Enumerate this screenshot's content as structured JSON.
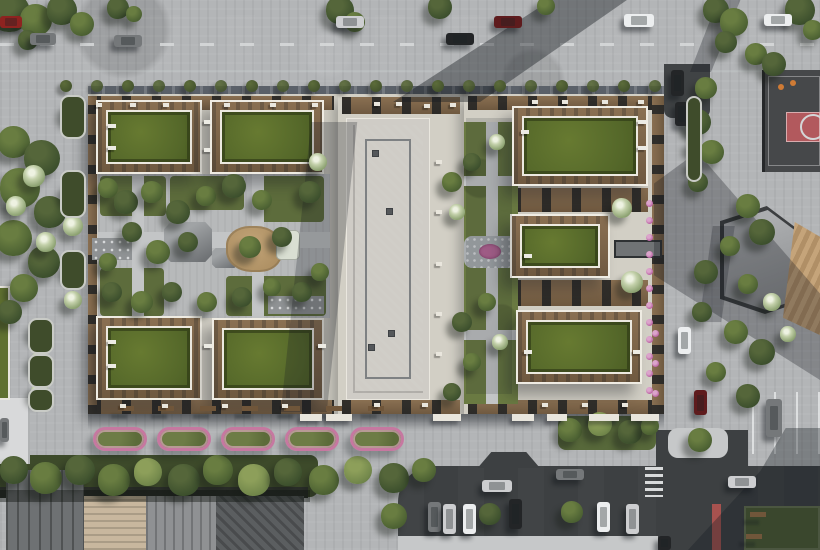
{
  "scene": {
    "type": "aerial-architectural-render",
    "subject": "Top-down aerial render of a residential block: perimeter buildings with grass green roofs and wooden roof terraces around landscaped courtyards, a tall concrete-roof tower, surrounding streets with cars, street parking, a basketball court with red key, an angular pavilion with wooden amphitheater steps, pink flower beds along the south sidewalk and a lawn at the bottom-right junction",
    "palette": {
      "css": {
        "grass": "#6e7d44",
        "grassd": "#5f6f3b",
        "road": "#3e4143",
        "lane": "#d8dadb",
        "pave": "#b3b5b7",
        "pavel": "#c6c8c9",
        "paved": "#9b9ea1",
        "cream": "#d2cfc5",
        "deck": "#8a7052",
        "deckd": "#6f5940",
        "facade": "#5b6169",
        "pink": "#c678a0"
      },
      "carColors": {
        "red": "#8e2320",
        "darkred": "#5e1b1d",
        "gray": "#75787a",
        "silver": "#cdced0",
        "black": "#232527",
        "white": "#eceeef"
      }
    },
    "greenRoofs": [
      [
        96,
        100,
        106,
        74
      ],
      [
        210,
        100,
        114,
        74
      ],
      [
        96,
        316,
        106,
        84
      ],
      [
        212,
        318,
        112,
        82
      ],
      [
        512,
        106,
        136,
        80
      ],
      [
        510,
        214,
        100,
        64
      ],
      [
        516,
        310,
        126,
        74
      ]
    ],
    "bushesRow": {
      "from": 66,
      "to": 655,
      "step": 31,
      "y": 86,
      "r": 6
    },
    "sprites": {
      "trees": [
        [
          10,
          12,
          20,
          0
        ],
        [
          36,
          20,
          16,
          1
        ],
        [
          62,
          10,
          15,
          0
        ],
        [
          82,
          24,
          12,
          1
        ],
        [
          118,
          8,
          11,
          0
        ],
        [
          134,
          14,
          8,
          1
        ],
        [
          28,
          40,
          10,
          0
        ],
        [
          340,
          10,
          14,
          0
        ],
        [
          355,
          22,
          10,
          1
        ],
        [
          440,
          7,
          12,
          0
        ],
        [
          546,
          6,
          9,
          1
        ],
        [
          716,
          10,
          13,
          0
        ],
        [
          734,
          22,
          14,
          1
        ],
        [
          800,
          10,
          15,
          0
        ],
        [
          813,
          30,
          10,
          1
        ],
        [
          726,
          42,
          11,
          0
        ],
        [
          756,
          54,
          11,
          1
        ],
        [
          774,
          64,
          12,
          0
        ],
        [
          14,
          142,
          16,
          1
        ],
        [
          42,
          158,
          18,
          0
        ],
        [
          20,
          188,
          20,
          1
        ],
        [
          50,
          212,
          16,
          0
        ],
        [
          14,
          238,
          18,
          1
        ],
        [
          44,
          262,
          16,
          0
        ],
        [
          24,
          288,
          14,
          1
        ],
        [
          10,
          312,
          12,
          0
        ],
        [
          34,
          176,
          11,
          3
        ],
        [
          16,
          206,
          10,
          3
        ],
        [
          46,
          242,
          10,
          3
        ],
        [
          73,
          112,
          11,
          3
        ],
        [
          73,
          192,
          11,
          3
        ],
        [
          73,
          226,
          10,
          3
        ],
        [
          73,
          268,
          10,
          3
        ],
        [
          73,
          300,
          9,
          3
        ],
        [
          40,
          330,
          10,
          3
        ],
        [
          40,
          362,
          10,
          3
        ],
        [
          40,
          392,
          9,
          3
        ],
        [
          108,
          188,
          10,
          1
        ],
        [
          126,
          202,
          12,
          0
        ],
        [
          152,
          192,
          11,
          1
        ],
        [
          178,
          212,
          12,
          0
        ],
        [
          206,
          196,
          10,
          1
        ],
        [
          234,
          186,
          12,
          0
        ],
        [
          262,
          200,
          10,
          1
        ],
        [
          310,
          192,
          11,
          0
        ],
        [
          132,
          232,
          10,
          0
        ],
        [
          158,
          252,
          12,
          1
        ],
        [
          188,
          242,
          10,
          0
        ],
        [
          250,
          247,
          11,
          1
        ],
        [
          282,
          237,
          10,
          0
        ],
        [
          108,
          262,
          9,
          1
        ],
        [
          112,
          292,
          10,
          0
        ],
        [
          142,
          302,
          11,
          1
        ],
        [
          172,
          292,
          10,
          0
        ],
        [
          207,
          302,
          10,
          1
        ],
        [
          242,
          297,
          10,
          0
        ],
        [
          272,
          287,
          9,
          1
        ],
        [
          302,
          292,
          10,
          0
        ],
        [
          320,
          272,
          9,
          1
        ],
        [
          318,
          162,
          9,
          3
        ],
        [
          452,
          182,
          10,
          1
        ],
        [
          472,
          162,
          9,
          0
        ],
        [
          457,
          212,
          8,
          3
        ],
        [
          487,
          302,
          9,
          1
        ],
        [
          462,
          322,
          10,
          0
        ],
        [
          472,
          362,
          9,
          1
        ],
        [
          500,
          342,
          8,
          3
        ],
        [
          452,
          392,
          9,
          0
        ],
        [
          497,
          142,
          8,
          3
        ],
        [
          622,
          208,
          10,
          3
        ],
        [
          632,
          282,
          11,
          3
        ],
        [
          706,
          88,
          11,
          1
        ],
        [
          698,
          122,
          13,
          0
        ],
        [
          712,
          152,
          12,
          1
        ],
        [
          698,
          182,
          10,
          0
        ],
        [
          748,
          206,
          12,
          1
        ],
        [
          762,
          232,
          13,
          0
        ],
        [
          730,
          246,
          10,
          1
        ],
        [
          706,
          272,
          12,
          0
        ],
        [
          748,
          284,
          10,
          1
        ],
        [
          702,
          312,
          10,
          0
        ],
        [
          736,
          332,
          12,
          1
        ],
        [
          762,
          352,
          13,
          0
        ],
        [
          716,
          372,
          10,
          1
        ],
        [
          748,
          396,
          12,
          0
        ],
        [
          700,
          440,
          12,
          1
        ],
        [
          788,
          334,
          8,
          3
        ],
        [
          772,
          302,
          9,
          3
        ],
        [
          694,
          104,
          7,
          2
        ],
        [
          694,
          124,
          7,
          2
        ],
        [
          694,
          146,
          7,
          2
        ],
        [
          694,
          164,
          6,
          2
        ],
        [
          14,
          470,
          14,
          0
        ],
        [
          46,
          478,
          16,
          1
        ],
        [
          80,
          470,
          15,
          0
        ],
        [
          114,
          480,
          16,
          1
        ],
        [
          148,
          472,
          14,
          4
        ],
        [
          184,
          480,
          16,
          0
        ],
        [
          218,
          470,
          15,
          1
        ],
        [
          254,
          480,
          16,
          4
        ],
        [
          288,
          472,
          14,
          0
        ],
        [
          324,
          480,
          15,
          1
        ],
        [
          358,
          470,
          14,
          4
        ],
        [
          394,
          478,
          15,
          0
        ],
        [
          424,
          470,
          12,
          1
        ],
        [
          394,
          516,
          13,
          1
        ],
        [
          490,
          514,
          11,
          0
        ],
        [
          572,
          512,
          11,
          1
        ],
        [
          570,
          430,
          12,
          1
        ],
        [
          600,
          424,
          12,
          4
        ],
        [
          630,
          432,
          12,
          0
        ],
        [
          650,
          426,
          9,
          1
        ]
      ],
      "cars": [
        {
          "x": 0,
          "y": 16,
          "w": 22,
          "h": 12,
          "c": "red"
        },
        {
          "x": 30,
          "y": 33,
          "w": 26,
          "h": 12,
          "c": "gray"
        },
        {
          "x": 114,
          "y": 35,
          "w": 28,
          "h": 12,
          "c": "gray"
        },
        {
          "x": 336,
          "y": 16,
          "w": 28,
          "h": 12,
          "c": "silver"
        },
        {
          "x": 446,
          "y": 33,
          "w": 28,
          "h": 12,
          "c": "black"
        },
        {
          "x": 494,
          "y": 16,
          "w": 28,
          "h": 12,
          "c": "darkred"
        },
        {
          "x": 624,
          "y": 14,
          "w": 30,
          "h": 13,
          "c": "white"
        },
        {
          "x": 764,
          "y": 14,
          "w": 28,
          "h": 12,
          "c": "white"
        },
        {
          "x": 671,
          "y": 70,
          "w": 13,
          "h": 26,
          "c": "black"
        },
        {
          "x": 675,
          "y": 102,
          "w": 13,
          "h": 24,
          "c": "black"
        },
        {
          "x": 678,
          "y": 327,
          "w": 13,
          "h": 27,
          "c": "white"
        },
        {
          "x": 694,
          "y": 390,
          "w": 13,
          "h": 25,
          "c": "darkred"
        },
        {
          "x": 766,
          "y": 399,
          "w": 16,
          "h": 38,
          "c": "gray"
        },
        {
          "x": 482,
          "y": 480,
          "w": 30,
          "h": 12,
          "c": "silver"
        },
        {
          "x": 556,
          "y": 469,
          "w": 28,
          "h": 11,
          "c": "gray"
        },
        {
          "x": 428,
          "y": 502,
          "w": 13,
          "h": 30,
          "c": "gray"
        },
        {
          "x": 443,
          "y": 504,
          "w": 13,
          "h": 30,
          "c": "silver"
        },
        {
          "x": 463,
          "y": 504,
          "w": 13,
          "h": 30,
          "c": "white"
        },
        {
          "x": 509,
          "y": 499,
          "w": 13,
          "h": 30,
          "c": "black"
        },
        {
          "x": 597,
          "y": 502,
          "w": 13,
          "h": 30,
          "c": "white"
        },
        {
          "x": 626,
          "y": 504,
          "w": 13,
          "h": 30,
          "c": "silver"
        },
        {
          "x": 728,
          "y": 476,
          "w": 28,
          "h": 12,
          "c": "silver"
        },
        {
          "x": 658,
          "y": 536,
          "w": 13,
          "h": 14,
          "c": "black"
        },
        {
          "x": 0,
          "y": 418,
          "w": 9,
          "h": 24,
          "c": "gray"
        }
      ],
      "flowerBeds": {
        "y": 427,
        "xs": [
          93,
          157,
          221,
          285,
          350
        ]
      },
      "benches": [
        [
          118,
          406,
          16,
          5
        ],
        [
          158,
          406,
          16,
          5
        ],
        [
          200,
          406,
          16,
          5
        ],
        [
          242,
          406,
          16,
          5
        ],
        [
          284,
          406,
          16,
          5
        ],
        [
          326,
          406,
          16,
          5
        ],
        [
          368,
          406,
          16,
          5
        ],
        [
          750,
          512,
          16,
          5
        ],
        [
          746,
          534,
          16,
          5
        ]
      ],
      "canopies": [
        [
          300,
          414,
          22
        ],
        [
          326,
          414,
          26
        ],
        [
          433,
          414,
          28
        ],
        [
          512,
          414,
          22
        ],
        [
          547,
          414,
          20
        ],
        [
          589,
          414,
          30
        ],
        [
          631,
          414,
          28
        ]
      ],
      "planterBeds": [
        [
          60,
          95,
          26,
          44
        ],
        [
          60,
          170,
          26,
          48
        ],
        [
          60,
          250,
          26,
          40
        ],
        [
          28,
          318,
          26,
          36
        ],
        [
          28,
          354,
          26,
          34
        ],
        [
          28,
          388,
          26,
          24
        ],
        [
          686,
          96,
          16,
          86
        ]
      ],
      "flowerDots": [
        [
          646,
          200
        ],
        [
          646,
          217
        ],
        [
          646,
          234
        ],
        [
          646,
          251
        ],
        [
          646,
          268
        ],
        [
          646,
          285
        ],
        [
          646,
          302
        ],
        [
          646,
          319
        ],
        [
          646,
          336
        ],
        [
          646,
          353
        ],
        [
          646,
          370
        ],
        [
          646,
          387
        ],
        [
          652,
          330
        ],
        [
          652,
          360
        ],
        [
          652,
          390
        ]
      ],
      "figures": [
        [
          778,
          84
        ],
        [
          790,
          80
        ]
      ],
      "vents": [
        [
          386,
          208
        ],
        [
          368,
          344
        ],
        [
          388,
          330
        ],
        [
          372,
          150
        ]
      ],
      "deckItems": [
        [
          96,
          103
        ],
        [
          130,
          103
        ],
        [
          163,
          103
        ],
        [
          224,
          103
        ],
        [
          270,
          103
        ],
        [
          312,
          103
        ],
        [
          374,
          102
        ],
        [
          396,
          102
        ],
        [
          424,
          104
        ],
        [
          450,
          103
        ],
        [
          532,
          100
        ],
        [
          562,
          100
        ],
        [
          602,
          100
        ],
        [
          638,
          100
        ],
        [
          120,
          404
        ],
        [
          162,
          404
        ],
        [
          222,
          404
        ],
        [
          282,
          404
        ],
        [
          374,
          403
        ],
        [
          422,
          403
        ],
        [
          542,
          403
        ],
        [
          582,
          403
        ],
        [
          622,
          403
        ],
        [
          436,
          160
        ],
        [
          436,
          210
        ],
        [
          436,
          262
        ],
        [
          436,
          312
        ],
        [
          436,
          352
        ]
      ],
      "loungers": [
        [
          108,
          124
        ],
        [
          108,
          146
        ],
        [
          204,
          120
        ],
        [
          204,
          148
        ],
        [
          521,
          130
        ],
        [
          638,
          120
        ],
        [
          638,
          146
        ],
        [
          524,
          254
        ],
        [
          524,
          350
        ],
        [
          633,
          350
        ],
        [
          108,
          340
        ],
        [
          108,
          364
        ],
        [
          204,
          344
        ],
        [
          318,
          344
        ]
      ]
    }
  }
}
